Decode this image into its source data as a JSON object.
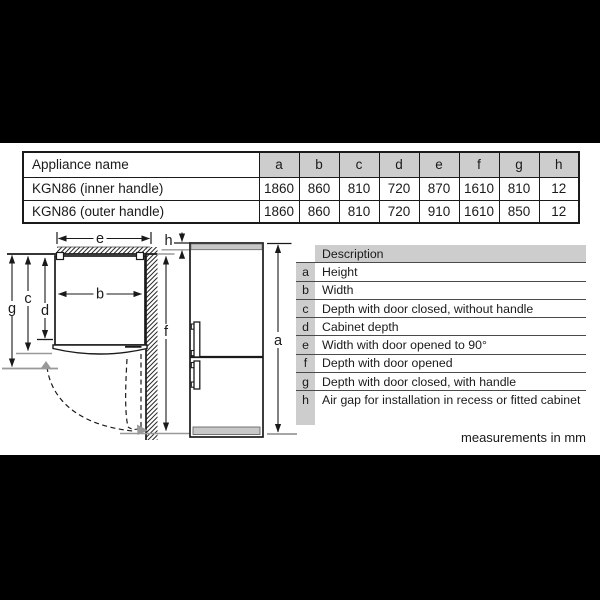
{
  "spec_table": {
    "header": [
      "Appliance name",
      "a",
      "b",
      "c",
      "d",
      "e",
      "f",
      "g",
      "h"
    ],
    "rows": [
      {
        "name": "KGN86 (inner handle)",
        "values": [
          "1860",
          "860",
          "810",
          "720",
          "870",
          "1610",
          "810",
          "12"
        ]
      },
      {
        "name": "KGN86 (outer handle)",
        "values": [
          "1860",
          "860",
          "810",
          "720",
          "910",
          "1610",
          "850",
          "12"
        ]
      }
    ]
  },
  "description_table": {
    "title": "Description",
    "rows": [
      {
        "key": "a",
        "text": "Height"
      },
      {
        "key": "b",
        "text": "Width"
      },
      {
        "key": "c",
        "text": "Depth with door closed, without handle"
      },
      {
        "key": "d",
        "text": "Cabinet depth"
      },
      {
        "key": "e",
        "text": "Width with door opened to 90°"
      },
      {
        "key": "f",
        "text": "Depth with door opened"
      },
      {
        "key": "g",
        "text": "Depth with door closed, with handle"
      },
      {
        "key": "h",
        "text": "Air gap for installation in recess or fitted cabinet"
      }
    ]
  },
  "diagram": {
    "labels": {
      "a": "a",
      "b": "b",
      "c": "c",
      "d": "d",
      "e": "e",
      "f": "f",
      "g": "g",
      "h": "h"
    }
  },
  "footer": {
    "note": "measurements in mm"
  },
  "colors": {
    "cell_fill": "#cdcdcd",
    "line": "#1a1a1a",
    "gray_line": "#999999",
    "appliance_gray": "#c8c8c8"
  }
}
